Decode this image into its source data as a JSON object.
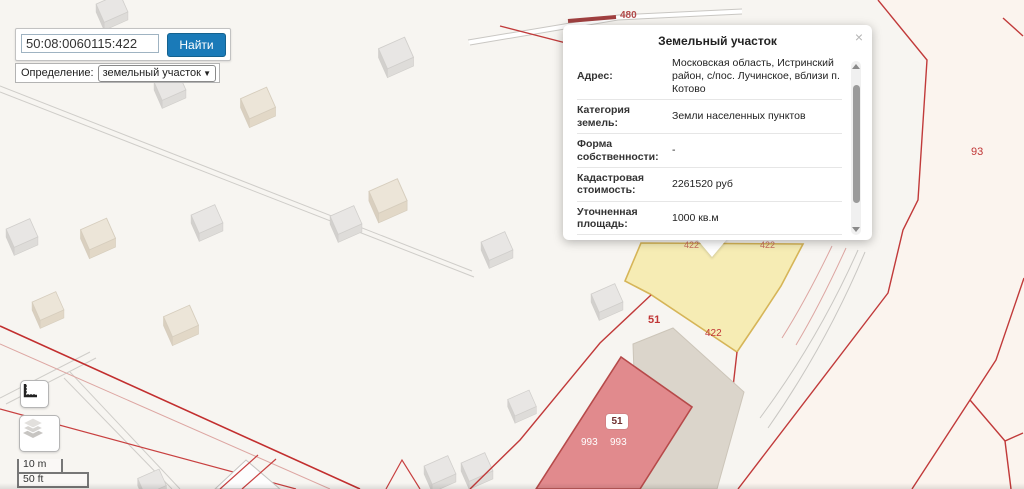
{
  "search": {
    "query": "50:08:0060115:422",
    "button_label": "Найти"
  },
  "filter": {
    "label": "Определение:",
    "selected_option": "земельный участок"
  },
  "popup": {
    "title": "Земельный участок",
    "close": "×",
    "rows": [
      {
        "label": "Адрес:",
        "value": "Московская область, Истринский район, с/пос. Лучинское, вблизи п. Котово"
      },
      {
        "label": "Категория земель:",
        "value": "Земли населенных пунктов"
      },
      {
        "label": "Форма собственности:",
        "value": "-"
      },
      {
        "label": "Кадастровая стоимость:",
        "value": "2261520 руб"
      },
      {
        "label": "Уточненная площадь:",
        "value": "1000 кв.м"
      },
      {
        "label": "Разрешенное использование:",
        "value": "для ведения личного подсобного хозяйства (приусадебный земельный участок)"
      }
    ]
  },
  "map_labels": {
    "selected_parcel": "422",
    "selected_parcel_top_left": "422",
    "selected_parcel_top_right": "422",
    "neighbor_parcel": "51",
    "building_number": "51",
    "building_area_left": "993",
    "building_area_right": "993",
    "right_parcel": "93",
    "road_number": "480"
  },
  "scale": {
    "metric": "10 m",
    "imperial": "50 ft"
  },
  "colors": {
    "accent_blue": "#1a7ab8",
    "boundary_red": "#c13a3a",
    "selected_parcel_fill": "#f6ecb4",
    "building_fill_pink": "#e18a8d"
  }
}
